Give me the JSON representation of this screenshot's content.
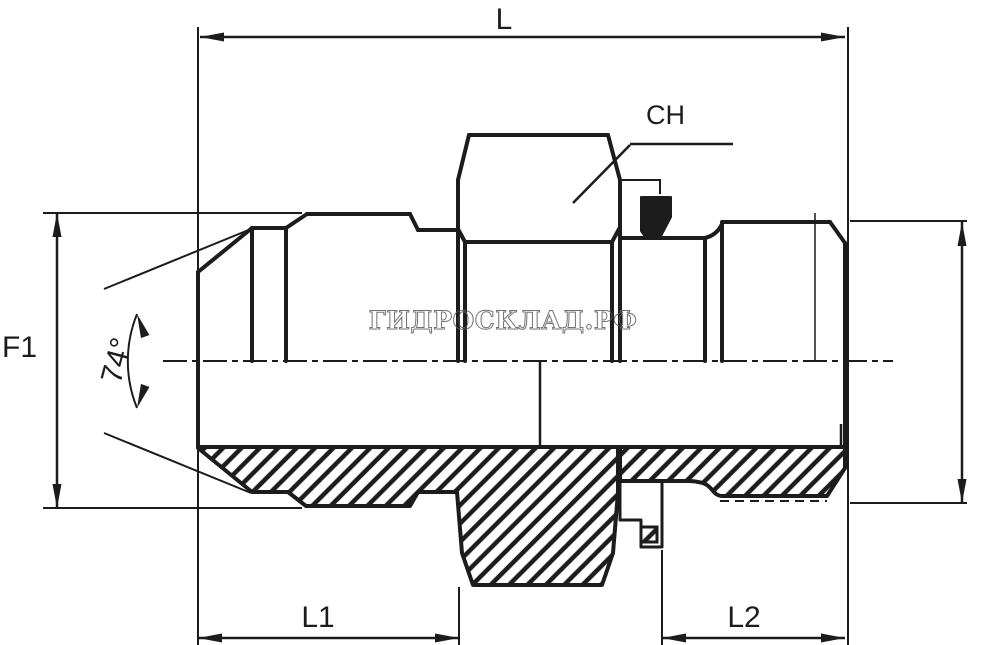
{
  "drawing": {
    "dimension_labels": {
      "overall_length": "L",
      "hex_across_flats": "CH",
      "flare_thread_diameter": "F1",
      "cone_angle": "74°",
      "left_end_length": "L1",
      "right_end_length": "L2"
    },
    "watermark_text": "ГИДРОСКЛАД.РФ",
    "colors": {
      "line_color": "#1c1c1c",
      "background": "#ffffff",
      "watermark_color": "#5a5a5a"
    }
  }
}
